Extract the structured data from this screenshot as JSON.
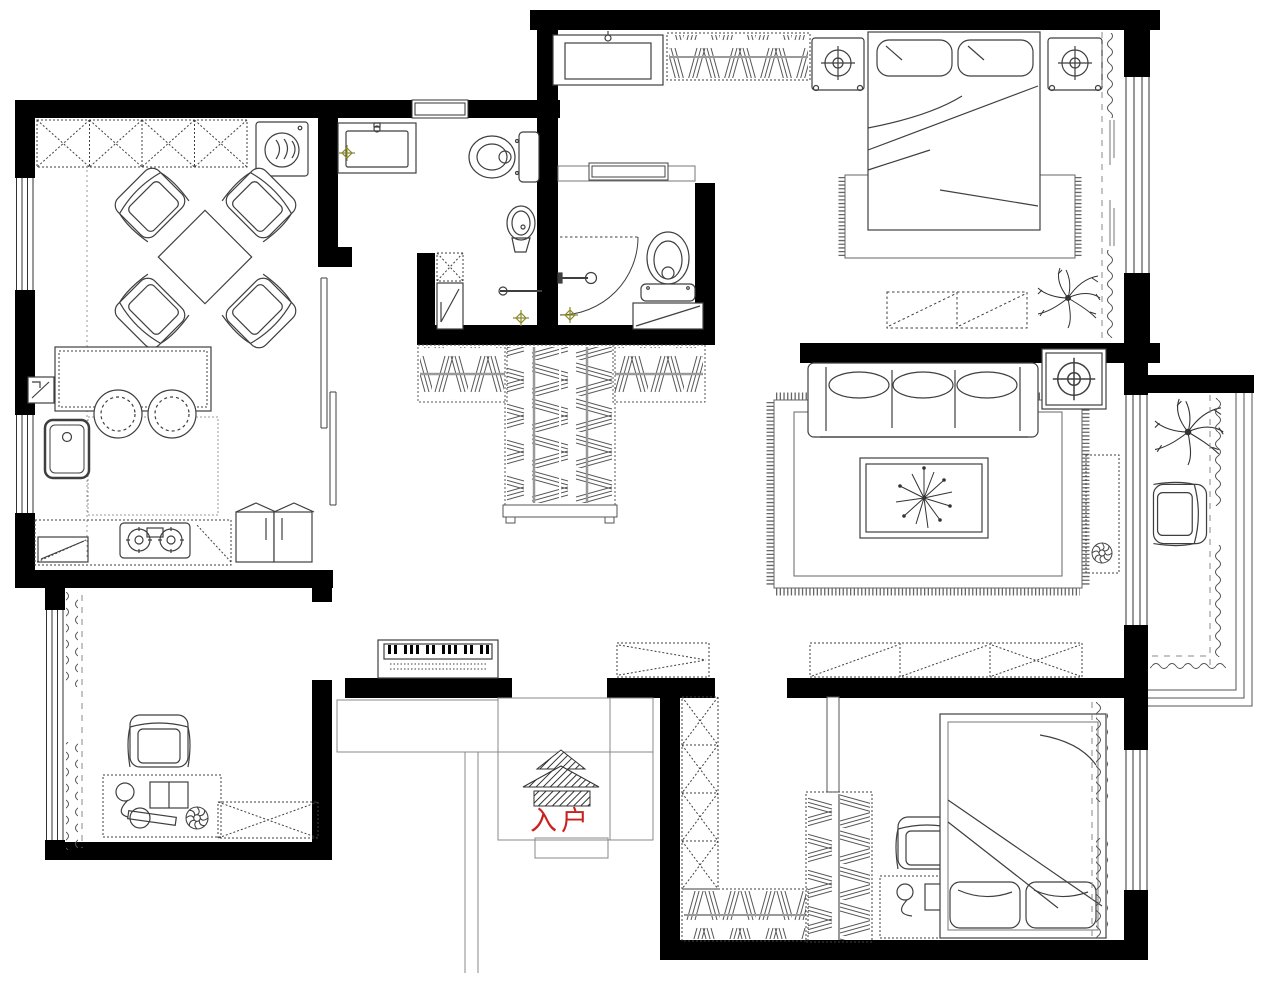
{
  "canvas": {
    "width": 1274,
    "height": 990,
    "background": "#ffffff"
  },
  "palette": {
    "wall": "#000000",
    "line": "#3f3f3f",
    "light_line": "#8a8a8a",
    "dash_line": "#666666",
    "drain": "#8a8a2e",
    "entry_red": "#c9221e"
  },
  "entry": {
    "label": "入户",
    "icon": "entry-canopy-icon"
  },
  "rooms": [
    {
      "id": "dining-room",
      "furniture": [
        "wall-cabinets-x",
        "washing-machine",
        "dining-table",
        "dining-chair x4"
      ]
    },
    {
      "id": "kitchen",
      "furniture": [
        "island-counter",
        "bar-stool x2",
        "kitchen-sink",
        "gas-stove",
        "base-counter",
        "refrigerator",
        "meter-box"
      ]
    },
    {
      "id": "bathroom-main",
      "furniture": [
        "vanity-sink",
        "toilet",
        "pedestal-sink",
        "floor-drain",
        "top-window"
      ]
    },
    {
      "id": "shower-room",
      "furniture": [
        "storage-cell",
        "shower-tray",
        "towel-bar",
        "floor-drain"
      ]
    },
    {
      "id": "bathroom-second",
      "furniture": [
        "swing-door",
        "shower-head",
        "toilet",
        "low-cabinet",
        "floor-drain",
        "top-window"
      ]
    },
    {
      "id": "master-bedroom",
      "furniture": [
        "dresser-mirror",
        "hanging-wardrobe",
        "nightstand-lamp x2",
        "double-bed",
        "rug",
        "foot-bench",
        "plant",
        "curtains",
        "side-window"
      ]
    },
    {
      "id": "walk-in-closet",
      "furniture": [
        "wardrobe-left-wing",
        "wardrobe-center-column",
        "wardrobe-right-wing"
      ]
    },
    {
      "id": "living-room",
      "furniture": [
        "three-seat-sofa",
        "fringed-rug",
        "coffee-table-plant",
        "corner-lamp-table",
        "tv-cabinet",
        "sideboard-x",
        "shoe-cabinet"
      ]
    },
    {
      "id": "balcony",
      "furniture": [
        "plant",
        "armchair",
        "curtains",
        "railing"
      ]
    },
    {
      "id": "hallway",
      "furniture": [
        "piano",
        "sliding-door"
      ]
    },
    {
      "id": "study",
      "furniture": [
        "armchair",
        "desk-with-lamp-book",
        "low-cabinet-x",
        "curtains",
        "side-window"
      ]
    },
    {
      "id": "bedroom-second",
      "furniture": [
        "wardrobe-x-column",
        "hanging-wardrobe x2",
        "partition-stub",
        "desk-with-lamp-book",
        "chair",
        "double-bed",
        "rug",
        "curtains",
        "side-window"
      ]
    },
    {
      "id": "entry-porch",
      "furniture": [
        "entry-canopy",
        "steps",
        "stair-lines"
      ]
    }
  ]
}
